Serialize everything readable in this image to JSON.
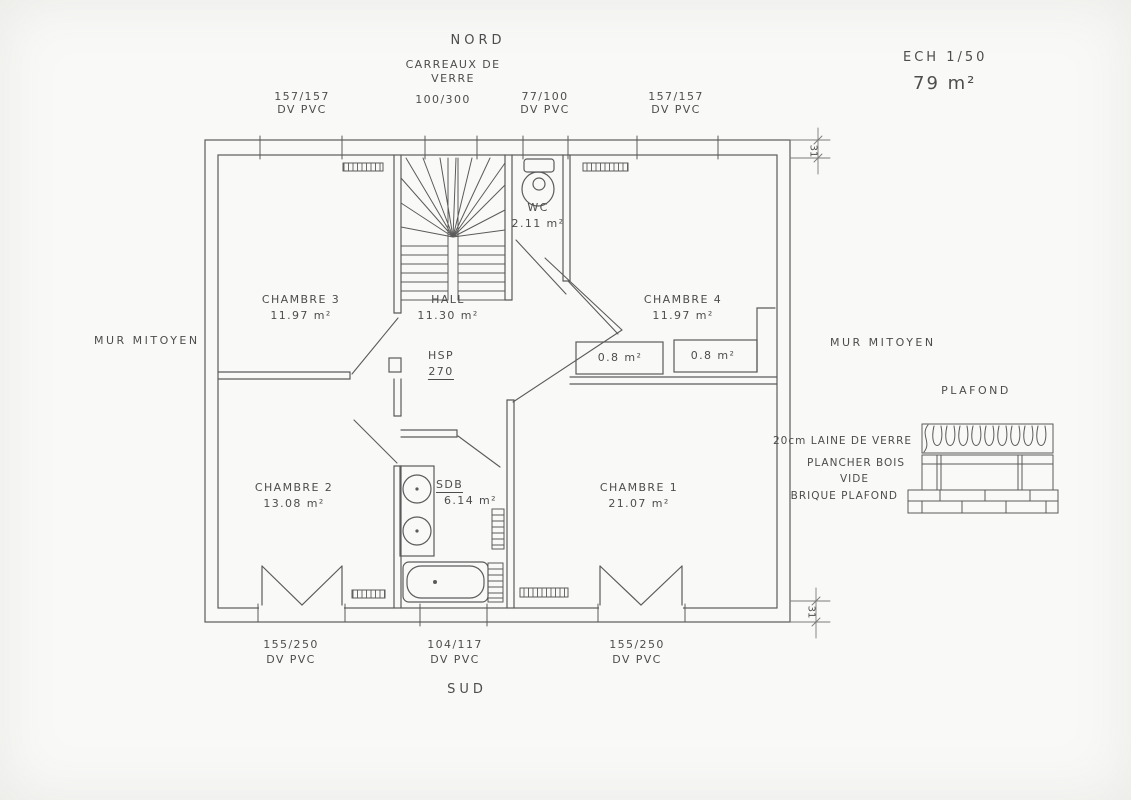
{
  "ink_color": "#5b5b5b",
  "paper_color": "#f9f9f7",
  "compass": {
    "north": "NORD",
    "south": "SUD"
  },
  "scale_label": "ECH 1/50",
  "total_area": "79 m²",
  "party_wall_left": "MUR MITOYEN",
  "party_wall_right": "MUR MITOYEN",
  "glass_blocks": {
    "line1": "CARREAUX DE",
    "line2": "VERRE",
    "size": "100/300"
  },
  "windows_top": [
    {
      "size": "157/157",
      "frame": "DV PVC"
    },
    {
      "size": "77/100",
      "frame": "DV PVC"
    },
    {
      "size": "157/157",
      "frame": "DV PVC"
    }
  ],
  "windows_bottom": [
    {
      "size": "155/250",
      "frame": "DV PVC"
    },
    {
      "size": "104/117",
      "frame": "DV PVC"
    },
    {
      "size": "155/250",
      "frame": "DV PVC"
    }
  ],
  "rooms": {
    "chambre3": {
      "name": "CHAMBRE 3",
      "area": "11.97 m²"
    },
    "hall": {
      "name": "HALL",
      "area": "11.30 m²"
    },
    "wc": {
      "name": "WC",
      "area": "2.11 m²"
    },
    "chambre4": {
      "name": "CHAMBRE 4",
      "area": "11.97 m²"
    },
    "chambre2": {
      "name": "CHAMBRE 2",
      "area": "13.08 m²"
    },
    "sdb": {
      "name": "SDB",
      "area": "6.14 m²"
    },
    "chambre1": {
      "name": "CHAMBRE 1",
      "area": "21.07 m²"
    },
    "closet_left": {
      "area": "0.8 m²"
    },
    "closet_right": {
      "area": "0.8 m²"
    }
  },
  "ceiling_height": {
    "label": "HSP",
    "value": "270"
  },
  "wall_thickness_top": "31",
  "wall_thickness_bottom": "31",
  "ceiling_section": {
    "title": "PLAFOND",
    "layers": [
      "20cm LAINE DE VERRE",
      "PLANCHER BOIS",
      "VIDE",
      "BRIQUE PLAFOND"
    ]
  }
}
